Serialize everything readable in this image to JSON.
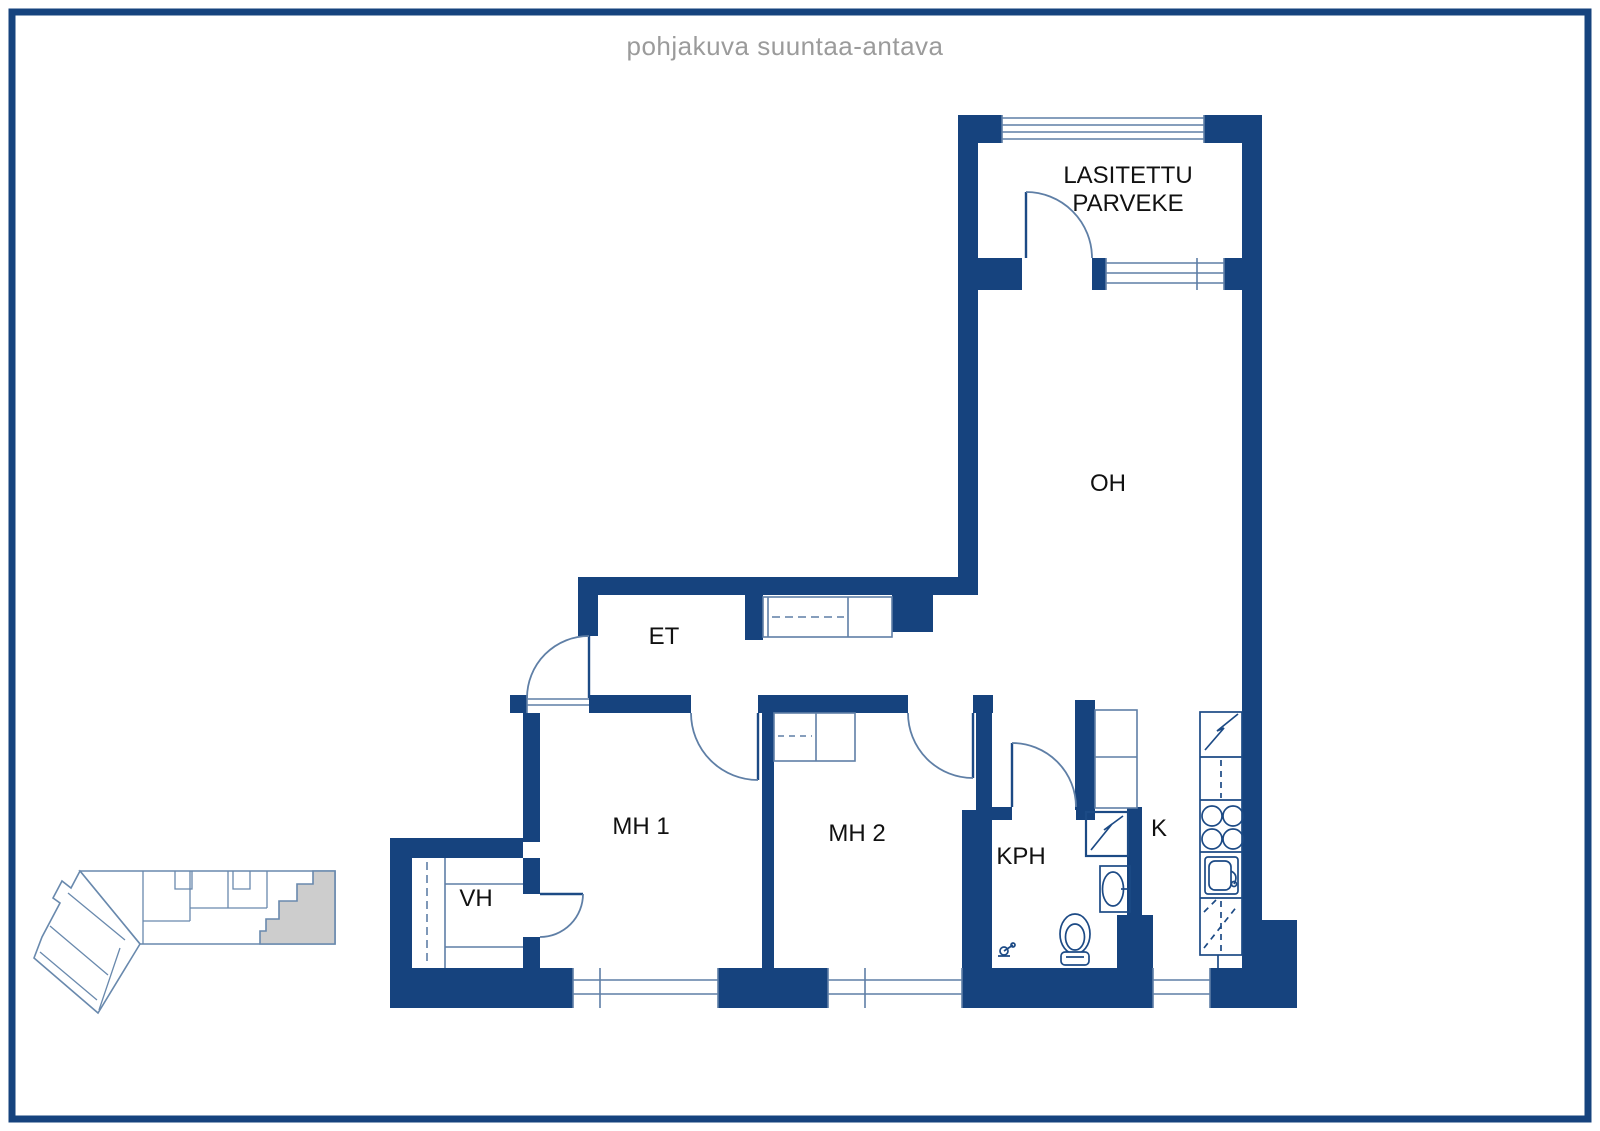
{
  "title": "pohjakuva suuntaa-antava",
  "rooms": {
    "balcony_line1": "LASITETTU",
    "balcony_line2": "PARVEKE",
    "living": "OH",
    "hall": "ET",
    "bedroom1": "MH 1",
    "bedroom2": "MH 2",
    "bathroom": "KPH",
    "kitchen": "K",
    "closet": "VH"
  },
  "colors": {
    "background": "#FFFFFF",
    "wall": "#16437E",
    "line": "#5F7FA6",
    "fixture": "#1C4A85",
    "label_text": "#111111",
    "title_text": "#9B9B9B",
    "keyplan_line": "#6989AD",
    "keyplan_highlight": "#CDCDCD"
  }
}
